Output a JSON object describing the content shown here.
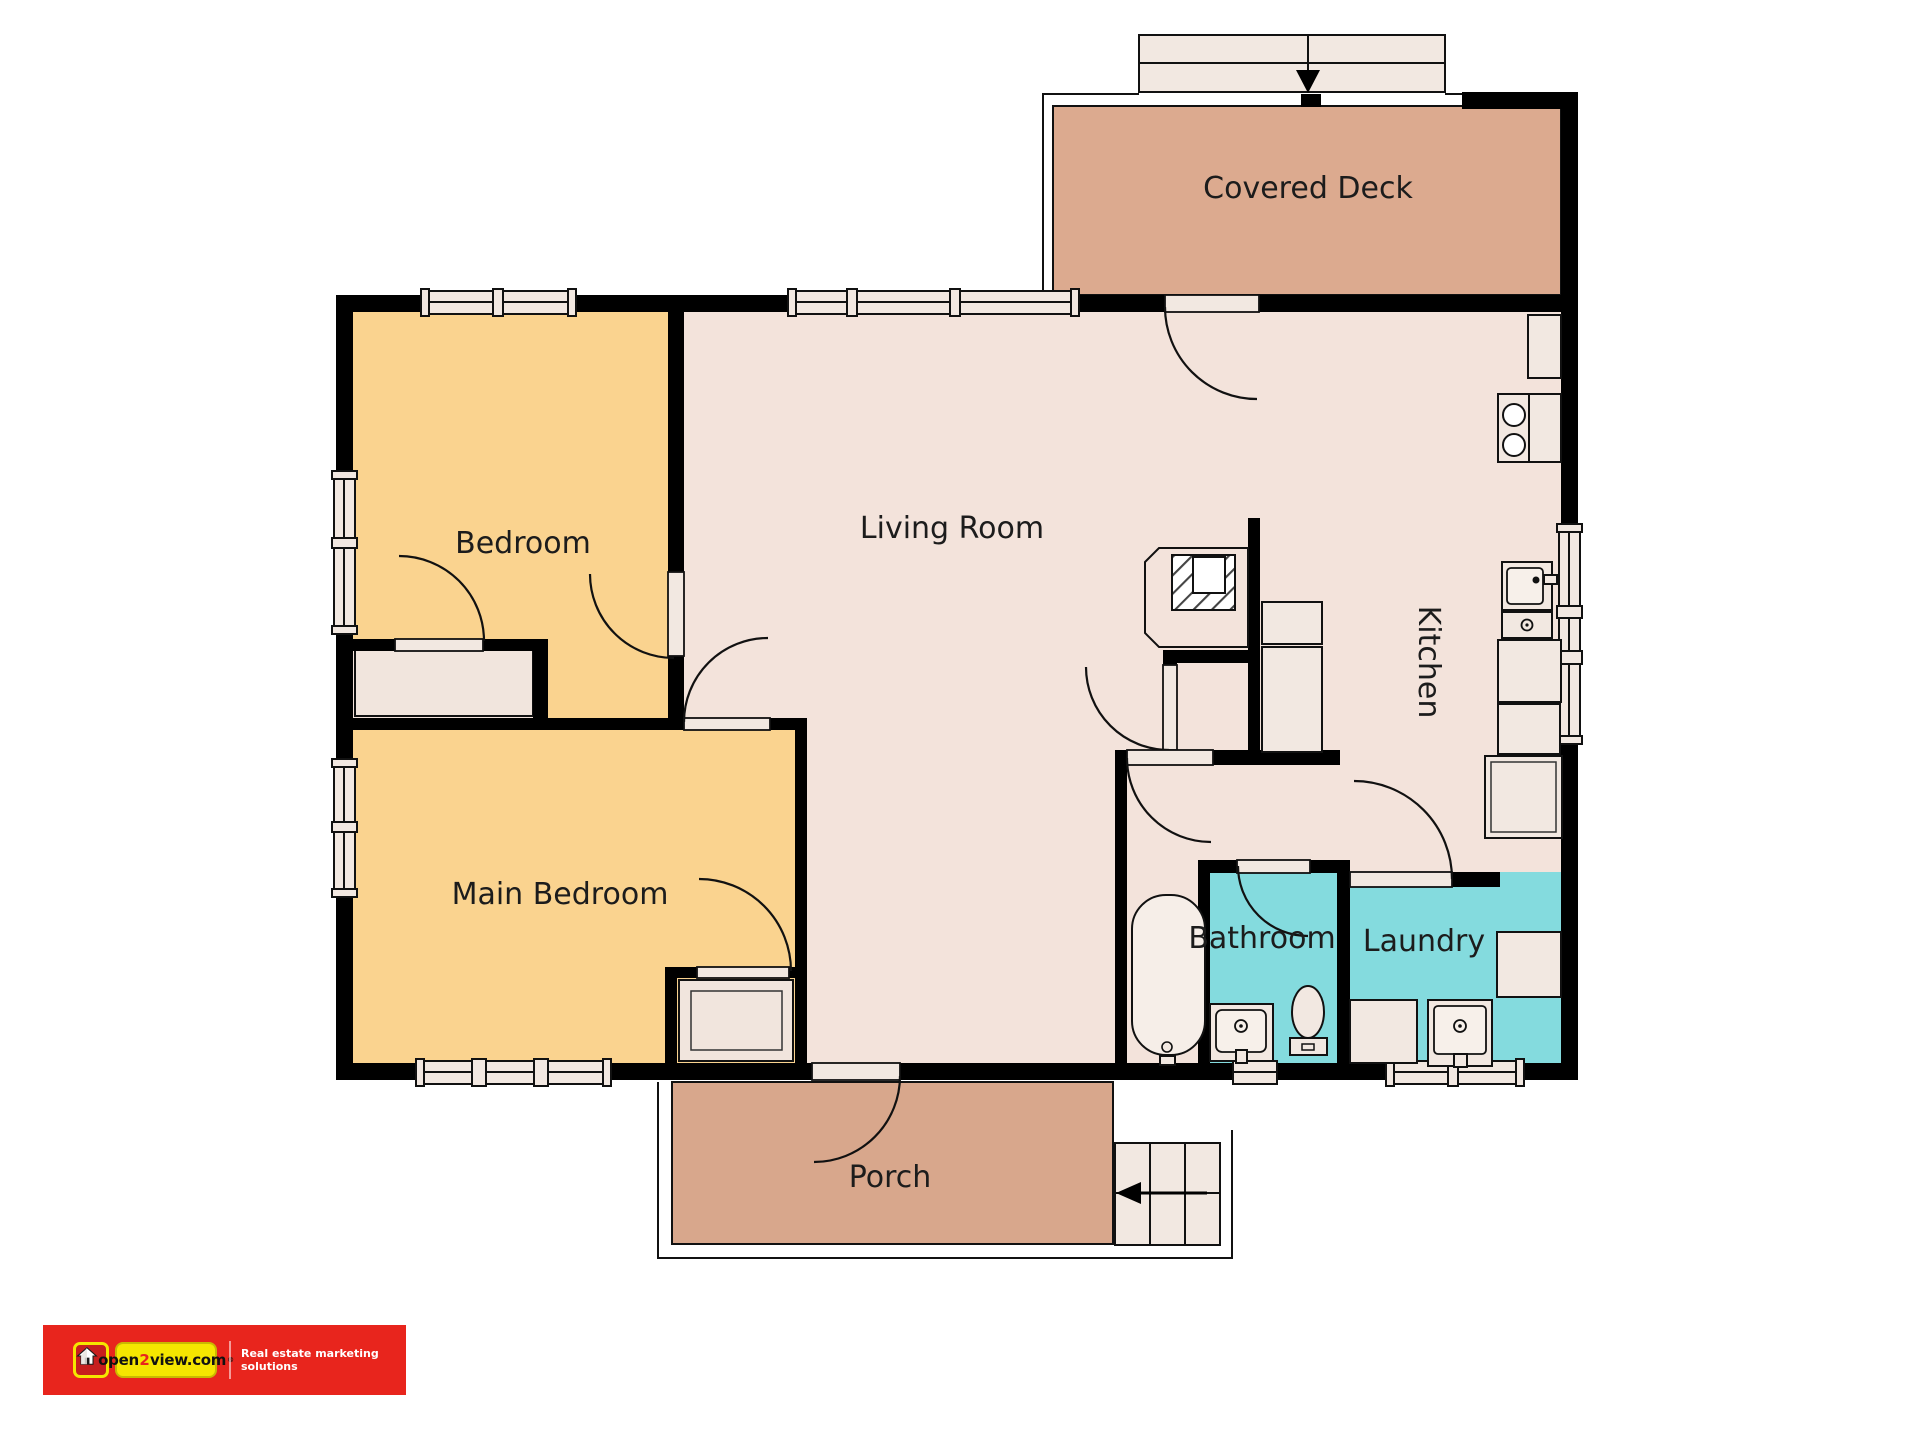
{
  "floor_plan": {
    "rooms": [
      {
        "id": "covered-deck",
        "label": "Covered Deck",
        "color": "#DCAA8F"
      },
      {
        "id": "bedroom",
        "label": "Bedroom",
        "color": "#FAD38F"
      },
      {
        "id": "living-room",
        "label": "Living Room",
        "color": "#F3E3DB"
      },
      {
        "id": "kitchen",
        "label": "Kitchen",
        "color": "#F3E3DB"
      },
      {
        "id": "main-bedroom",
        "label": "Main Bedroom",
        "color": "#FAD38F"
      },
      {
        "id": "bathroom",
        "label": "Bathroom",
        "color": "#84DBDE"
      },
      {
        "id": "laundry",
        "label": "Laundry",
        "color": "#84DBDE"
      },
      {
        "id": "porch",
        "label": "Porch",
        "color": "#D8A78C"
      }
    ],
    "wall_color": "#000000",
    "line_color": "#111111",
    "fixture_fill": "#F2E8E1",
    "closet_fill": "#F1E5DD",
    "tub_fill": "#F6EEE8"
  },
  "logo": {
    "brand": "open2view.com",
    "brand_prefix": "open",
    "brand_digit": "2",
    "brand_suffix": "view.com",
    "registered": "®",
    "tagline": "Real estate marketing solutions",
    "band_color": "#E8251D",
    "pill_color": "#F5E600",
    "icon": "house-icon"
  }
}
